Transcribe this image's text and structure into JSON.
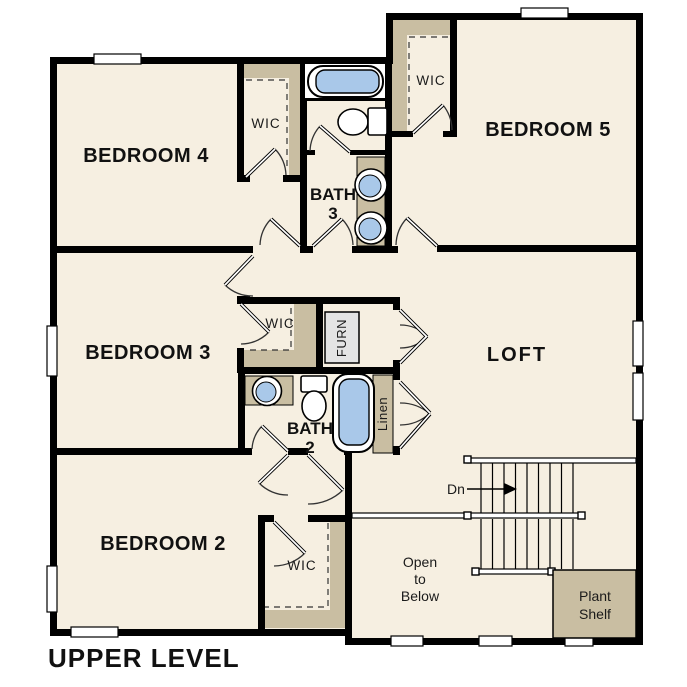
{
  "title": "UPPER LEVEL",
  "colors": {
    "floor": "#f6efe1",
    "closet_shade": "#c9bea2",
    "fixture_blue": "#a9c8e9",
    "wall": "#000000",
    "furnace_gray": "#e4e4e4",
    "page_background": "#ffffff"
  },
  "rooms": {
    "bedroom4": "BEDROOM 4",
    "bedroom5": "BEDROOM 5",
    "bedroom3": "BEDROOM 3",
    "bedroom2": "BEDROOM 2",
    "loft": "LOFT",
    "bath3": {
      "line1": "BATH",
      "line2": "3"
    },
    "bath2": {
      "line1": "BATH",
      "line2": "2"
    },
    "wic": "WIC"
  },
  "closets": {
    "furnace": "FURN",
    "linen": "Linen"
  },
  "stairs": {
    "direction": "Dn"
  },
  "open_to_below": {
    "line1": "Open",
    "line2": "to",
    "line3": "Below"
  },
  "plant_shelf": {
    "line1": "Plant",
    "line2": "Shelf"
  }
}
